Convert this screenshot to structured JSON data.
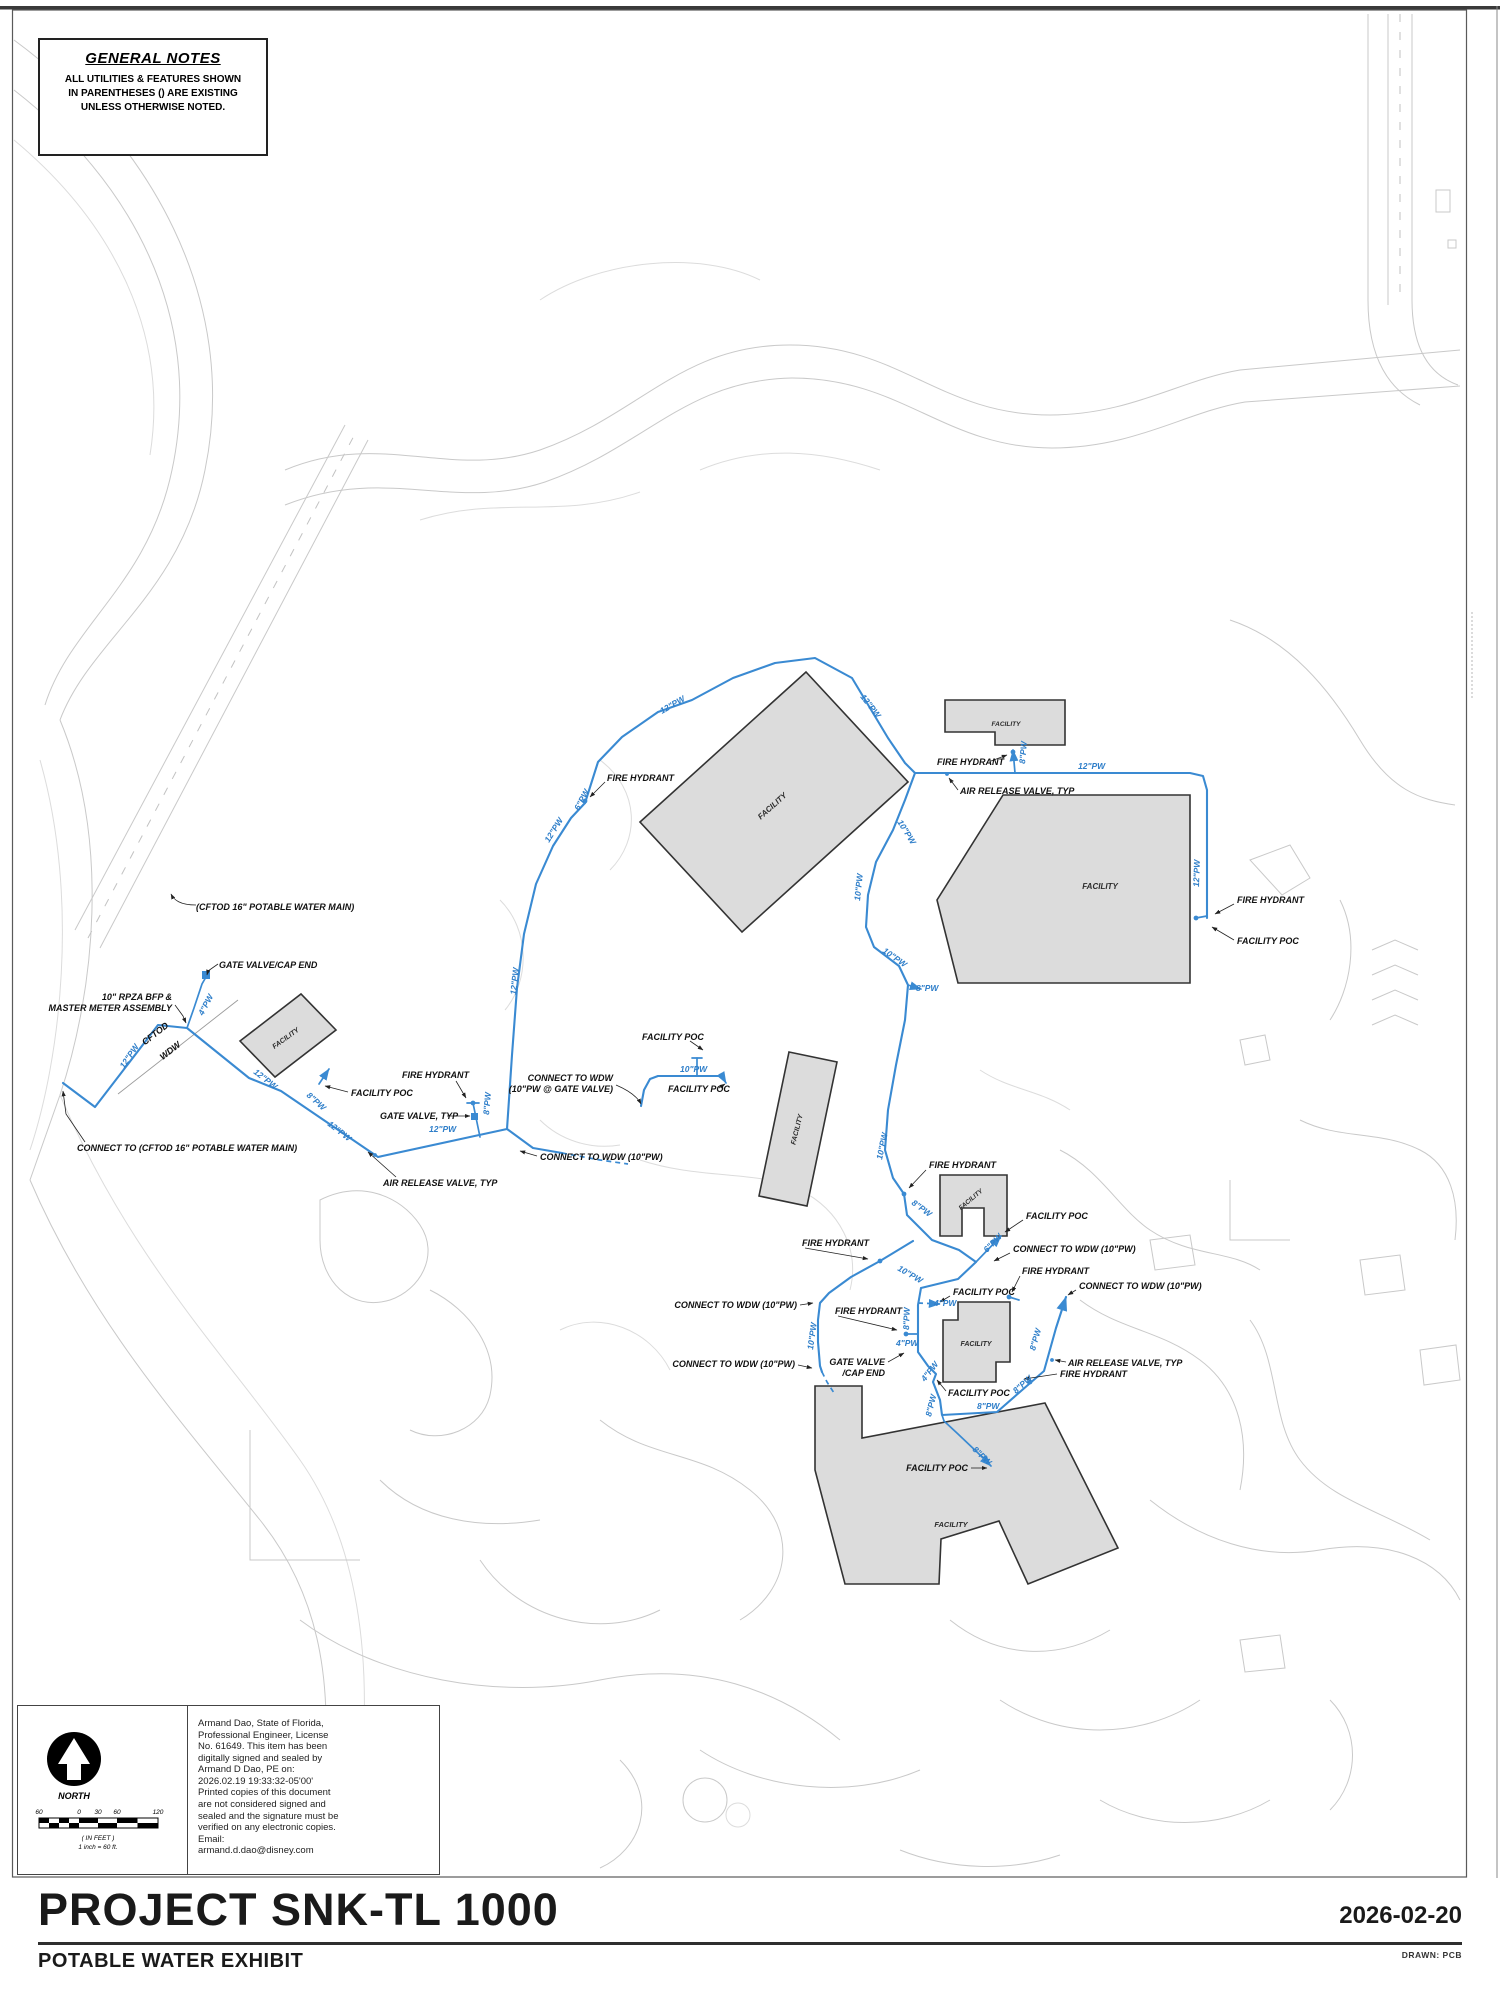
{
  "page": {
    "title": "PROJECT SNK-TL 1000",
    "subtitle": "POTABLE WATER EXHIBIT",
    "date": "2026-02-20",
    "drawn_by": "DRAWN: PCB"
  },
  "general_notes": {
    "title": "GENERAL NOTES",
    "body": "ALL UTILITIES & FEATURES SHOWN\nIN PARENTHESES () ARE EXISTING\nUNLESS OTHERWISE NOTED."
  },
  "north_scale": {
    "north_label": "NORTH",
    "ticks": [
      "60",
      "0",
      "30",
      "60",
      "120"
    ],
    "units": "( IN FEET )",
    "ratio": "1 inch = 60 ft."
  },
  "signature": {
    "text": "Armand Dao, State of Florida,\nProfessional Engineer, License\nNo. 61649.  This item has been\ndigitally signed and sealed by\nArmand D Dao, PE on:\n2026.02.19 19:33:32-05'00'\nPrinted copies of this document\nare not considered signed and\nsealed and the signature must be\nverified on any electronic copies.\nEmail:\narmand.d.dao@disney.com"
  },
  "map": {
    "facility_label": "FACILITY",
    "facilities": [
      {
        "x": 774,
        "y": 808,
        "r": -42,
        "s": 8
      },
      {
        "x": 1006,
        "y": 726,
        "r": 0,
        "s": 6.5
      },
      {
        "x": 1100,
        "y": 889,
        "r": 0,
        "s": 8
      },
      {
        "x": 287,
        "y": 1040,
        "r": -36,
        "s": 7
      },
      {
        "x": 799,
        "y": 1130,
        "r": -76,
        "s": 7
      },
      {
        "x": 972,
        "y": 1201,
        "r": -40,
        "s": 6.5
      },
      {
        "x": 976,
        "y": 1346,
        "r": 0,
        "s": 7
      },
      {
        "x": 951,
        "y": 1527,
        "r": 0,
        "s": 7.5
      }
    ],
    "pipe_labels": [
      {
        "t": "4\"PW",
        "x": 203,
        "y": 1016,
        "r": -62
      },
      {
        "t": "12\"PW",
        "x": 124,
        "y": 1069,
        "r": -56
      },
      {
        "t": "12\"PW",
        "x": 253,
        "y": 1073,
        "r": 38
      },
      {
        "t": "8\"PW",
        "x": 306,
        "y": 1096,
        "r": 42
      },
      {
        "t": "12\"PW",
        "x": 327,
        "y": 1125,
        "r": 38
      },
      {
        "t": "12\"PW",
        "x": 429,
        "y": 1132,
        "r": 0
      },
      {
        "t": "8\"PW",
        "x": 489,
        "y": 1115,
        "r": -85
      },
      {
        "t": "12\"PW",
        "x": 516,
        "y": 995,
        "r": -84
      },
      {
        "t": "12\"PW",
        "x": 549,
        "y": 843,
        "r": -58
      },
      {
        "t": "6\"PW",
        "x": 579,
        "y": 811,
        "r": -62
      },
      {
        "t": "12\"PW",
        "x": 662,
        "y": 714,
        "r": -30
      },
      {
        "t": "12\"PW",
        "x": 860,
        "y": 697,
        "r": 52
      },
      {
        "t": "8\"PW",
        "x": 1025,
        "y": 764,
        "r": -85
      },
      {
        "t": "12\"PW",
        "x": 1078,
        "y": 769,
        "r": 0
      },
      {
        "t": "12\"PW",
        "x": 1199,
        "y": 887,
        "r": -88
      },
      {
        "t": "10\"PW",
        "x": 897,
        "y": 822,
        "r": 58
      },
      {
        "t": "10\"PW",
        "x": 860,
        "y": 901,
        "r": -84
      },
      {
        "t": "10\"PW",
        "x": 882,
        "y": 952,
        "r": 35
      },
      {
        "t": "8\"PW",
        "x": 916,
        "y": 991,
        "r": 0
      },
      {
        "t": "10\"PW",
        "x": 882,
        "y": 1160,
        "r": -78
      },
      {
        "t": "8\"PW",
        "x": 911,
        "y": 1204,
        "r": 36
      },
      {
        "t": "6\"PW",
        "x": 987,
        "y": 1253,
        "r": -46
      },
      {
        "t": "10\"PW",
        "x": 897,
        "y": 1270,
        "r": 30
      },
      {
        "t": "4\"PW",
        "x": 934,
        "y": 1306,
        "r": 0
      },
      {
        "t": "10\"PW",
        "x": 813,
        "y": 1350,
        "r": -82
      },
      {
        "t": "8\"PW",
        "x": 909,
        "y": 1330,
        "r": -88
      },
      {
        "t": "4\"PW",
        "x": 896,
        "y": 1346,
        "r": 0
      },
      {
        "t": "4\"PW",
        "x": 925,
        "y": 1382,
        "r": -52
      },
      {
        "t": "8\"PW",
        "x": 931,
        "y": 1417,
        "r": -76
      },
      {
        "t": "8\"PW",
        "x": 977,
        "y": 1409,
        "r": 0
      },
      {
        "t": "8\"PW",
        "x": 972,
        "y": 1450,
        "r": 44
      },
      {
        "t": "8\"PW",
        "x": 1016,
        "y": 1394,
        "r": -42
      },
      {
        "t": "8\"PW",
        "x": 1035,
        "y": 1351,
        "r": -74
      },
      {
        "t": "10\"PW",
        "x": 680,
        "y": 1072,
        "r": 0
      }
    ],
    "callouts": [
      {
        "lines": [
          "(CFTOD 16\" POTABLE WATER MAIN)"
        ],
        "x": 196,
        "y": 910,
        "a": "start"
      },
      {
        "lines": [
          "GATE VALVE/CAP END"
        ],
        "x": 219,
        "y": 968,
        "a": "start"
      },
      {
        "lines": [
          "10\" RPZA BFP &",
          "MASTER METER ASSEMBLY"
        ],
        "x": 172,
        "y": 1000,
        "a": "end"
      },
      {
        "lines": [
          "CONNECT TO (CFTOD 16\" POTABLE WATER MAIN)"
        ],
        "x": 77,
        "y": 1151,
        "a": "start"
      },
      {
        "lines": [
          "FIRE HYDRANT"
        ],
        "x": 402,
        "y": 1078,
        "a": "start"
      },
      {
        "lines": [
          "FACILITY POC"
        ],
        "x": 351,
        "y": 1096,
        "a": "start"
      },
      {
        "lines": [
          "GATE VALVE, TYP"
        ],
        "x": 380,
        "y": 1119,
        "a": "start"
      },
      {
        "lines": [
          "AIR RELEASE VALVE, TYP"
        ],
        "x": 383,
        "y": 1186,
        "a": "start"
      },
      {
        "lines": [
          "CONNECT TO WDW (10\"PW)"
        ],
        "x": 540,
        "y": 1160,
        "a": "start"
      },
      {
        "lines": [
          "CONNECT TO WDW",
          "(10\"PW @ GATE VALVE)"
        ],
        "x": 613,
        "y": 1081,
        "a": "end"
      },
      {
        "lines": [
          "FACILITY POC"
        ],
        "x": 642,
        "y": 1040,
        "a": "start"
      },
      {
        "lines": [
          "FACILITY POC"
        ],
        "x": 668,
        "y": 1092,
        "a": "start"
      },
      {
        "lines": [
          "FIRE HYDRANT"
        ],
        "x": 607,
        "y": 781,
        "a": "start"
      },
      {
        "lines": [
          "FIRE HYDRANT"
        ],
        "x": 937,
        "y": 765,
        "a": "start"
      },
      {
        "lines": [
          "AIR RELEASE VALVE, TYP"
        ],
        "x": 960,
        "y": 794,
        "a": "start"
      },
      {
        "lines": [
          "FIRE HYDRANT"
        ],
        "x": 1237,
        "y": 903,
        "a": "start"
      },
      {
        "lines": [
          "FACILITY POC"
        ],
        "x": 1237,
        "y": 944,
        "a": "start"
      },
      {
        "lines": [
          "FIRE HYDRANT"
        ],
        "x": 929,
        "y": 1168,
        "a": "start"
      },
      {
        "lines": [
          "FACILITY POC"
        ],
        "x": 1026,
        "y": 1219,
        "a": "start"
      },
      {
        "lines": [
          "CONNECT TO WDW (10\"PW)"
        ],
        "x": 1013,
        "y": 1252,
        "a": "start"
      },
      {
        "lines": [
          "FIRE HYDRANT"
        ],
        "x": 1022,
        "y": 1274,
        "a": "start"
      },
      {
        "lines": [
          "CONNECT TO WDW (10\"PW)"
        ],
        "x": 1079,
        "y": 1289,
        "a": "start"
      },
      {
        "lines": [
          "FACILITY POC"
        ],
        "x": 953,
        "y": 1295,
        "a": "start"
      },
      {
        "lines": [
          "FIRE HYDRANT"
        ],
        "x": 802,
        "y": 1246,
        "a": "start"
      },
      {
        "lines": [
          "CONNECT TO WDW (10\"PW)"
        ],
        "x": 797,
        "y": 1308,
        "a": "end"
      },
      {
        "lines": [
          "FIRE HYDRANT"
        ],
        "x": 835,
        "y": 1314,
        "a": "start"
      },
      {
        "lines": [
          "CONNECT TO WDW (10\"PW)"
        ],
        "x": 795,
        "y": 1367,
        "a": "end"
      },
      {
        "lines": [
          "GATE VALVE",
          "/CAP END"
        ],
        "x": 885,
        "y": 1365,
        "a": "end"
      },
      {
        "lines": [
          "AIR RELEASE VALVE, TYP"
        ],
        "x": 1068,
        "y": 1366,
        "a": "start"
      },
      {
        "lines": [
          "FIRE HYDRANT"
        ],
        "x": 1060,
        "y": 1377,
        "a": "start"
      },
      {
        "lines": [
          "FACILITY POC"
        ],
        "x": 948,
        "y": 1396,
        "a": "start"
      },
      {
        "lines": [
          "FACILITY POC"
        ],
        "x": 968,
        "y": 1471,
        "a": "end"
      },
      {
        "lines": [
          "CFTOD"
        ],
        "x": 157,
        "y": 1036,
        "a": "middle",
        "r": -38
      },
      {
        "lines": [
          "WDW"
        ],
        "x": 172,
        "y": 1053,
        "a": "middle",
        "r": -38
      }
    ]
  }
}
